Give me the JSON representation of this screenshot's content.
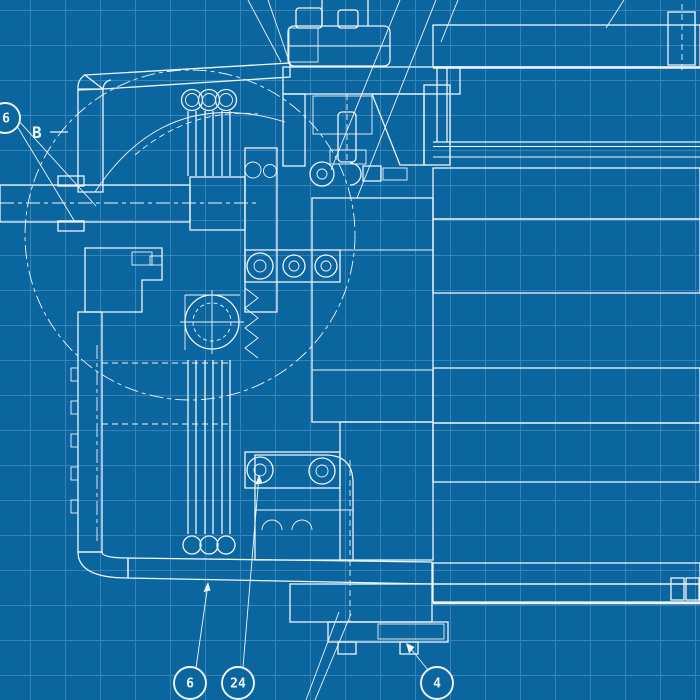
{
  "colors": {
    "bg": "#0b66a0",
    "line": "#eef5fb",
    "hatch": "#d9eaf5",
    "grid": "#5d9ac6"
  },
  "annotations": {
    "detail_label": {
      "text": "B"
    },
    "balloons": [
      {
        "id": "left-edge",
        "label": "6"
      },
      {
        "id": "bottom-1",
        "label": "6"
      },
      {
        "id": "bottom-2",
        "label": "24"
      },
      {
        "id": "bottom-3",
        "label": "4"
      }
    ]
  }
}
